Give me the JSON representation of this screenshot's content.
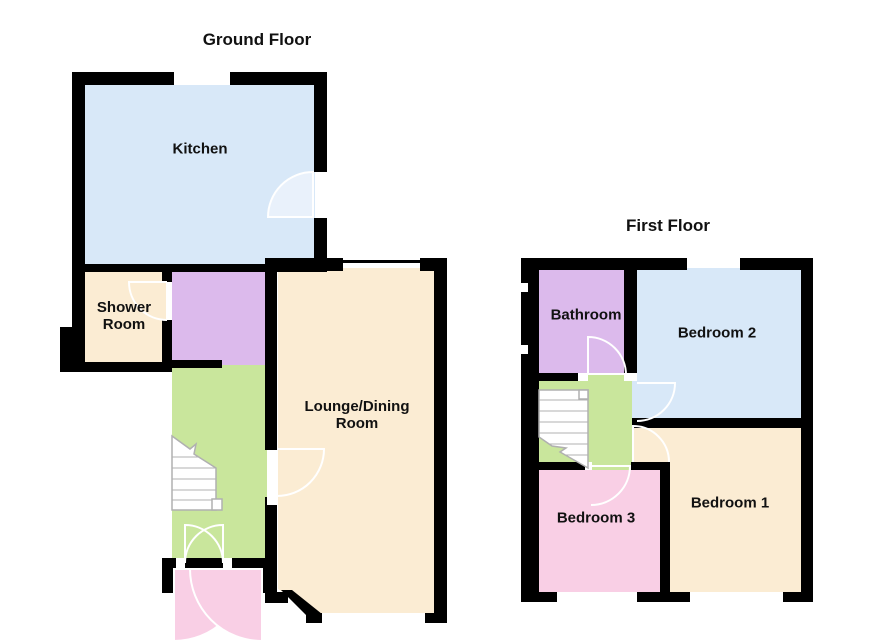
{
  "ground_floor": {
    "title": "Ground Floor",
    "rooms": {
      "kitchen": {
        "label": "Kitchen"
      },
      "shower_room": {
        "label": "Shower Room"
      },
      "hallway": {
        "label": ""
      },
      "stairs_hall": {
        "label": ""
      },
      "lounge_dining": {
        "label": "Lounge/Dining Room"
      },
      "porch": {
        "label": ""
      }
    }
  },
  "first_floor": {
    "title": "First Floor",
    "rooms": {
      "bathroom": {
        "label": "Bathroom"
      },
      "bedroom_2": {
        "label": "Bedroom 2"
      },
      "landing": {
        "label": ""
      },
      "bedroom_3": {
        "label": "Bedroom 3"
      },
      "bedroom_1": {
        "label": "Bedroom 1"
      }
    }
  },
  "colors": {
    "wall": "#000000",
    "kitchen": "#d8e8f8",
    "cream": "#fbecd3",
    "purple": "#dcbaec",
    "green": "#c9e69c",
    "pink": "#f9cfe5",
    "swing": "#ffffff",
    "swingfill": "#e9f1fb",
    "stairs": "#b0b0b0",
    "bg": "#ffffff",
    "text": "#111111"
  }
}
